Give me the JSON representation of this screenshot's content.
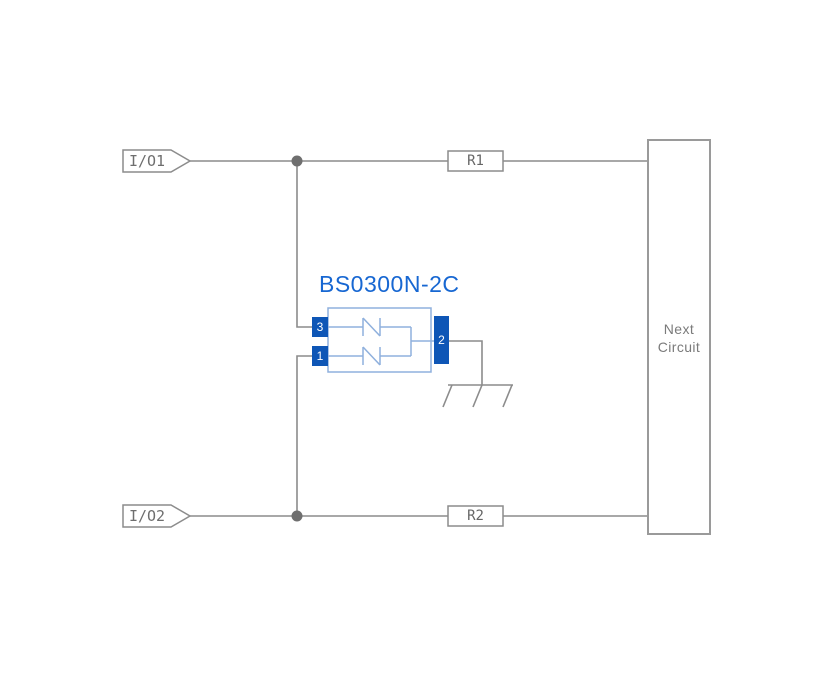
{
  "diagram": {
    "component": {
      "name": "BS0300N-2C",
      "pins": [
        {
          "number": "3"
        },
        {
          "number": "1"
        },
        {
          "number": "2"
        }
      ]
    },
    "ports": [
      {
        "label": "I/O1"
      },
      {
        "label": "I/O2"
      }
    ],
    "resistors": [
      {
        "label": "R1"
      },
      {
        "label": "R2"
      }
    ],
    "next_circuit": {
      "line1": "Next",
      "line2": "Circuit"
    },
    "colors": {
      "wire_gray": "#8c8c8c",
      "junction_gray": "#6f6f6f",
      "box_border_gray": "#9a9a9a",
      "label_gray": "#6e6e6e",
      "pin_blue": "#0e56b6",
      "body_light_blue": "#8fb0dd",
      "title_blue": "#1767d2"
    }
  }
}
